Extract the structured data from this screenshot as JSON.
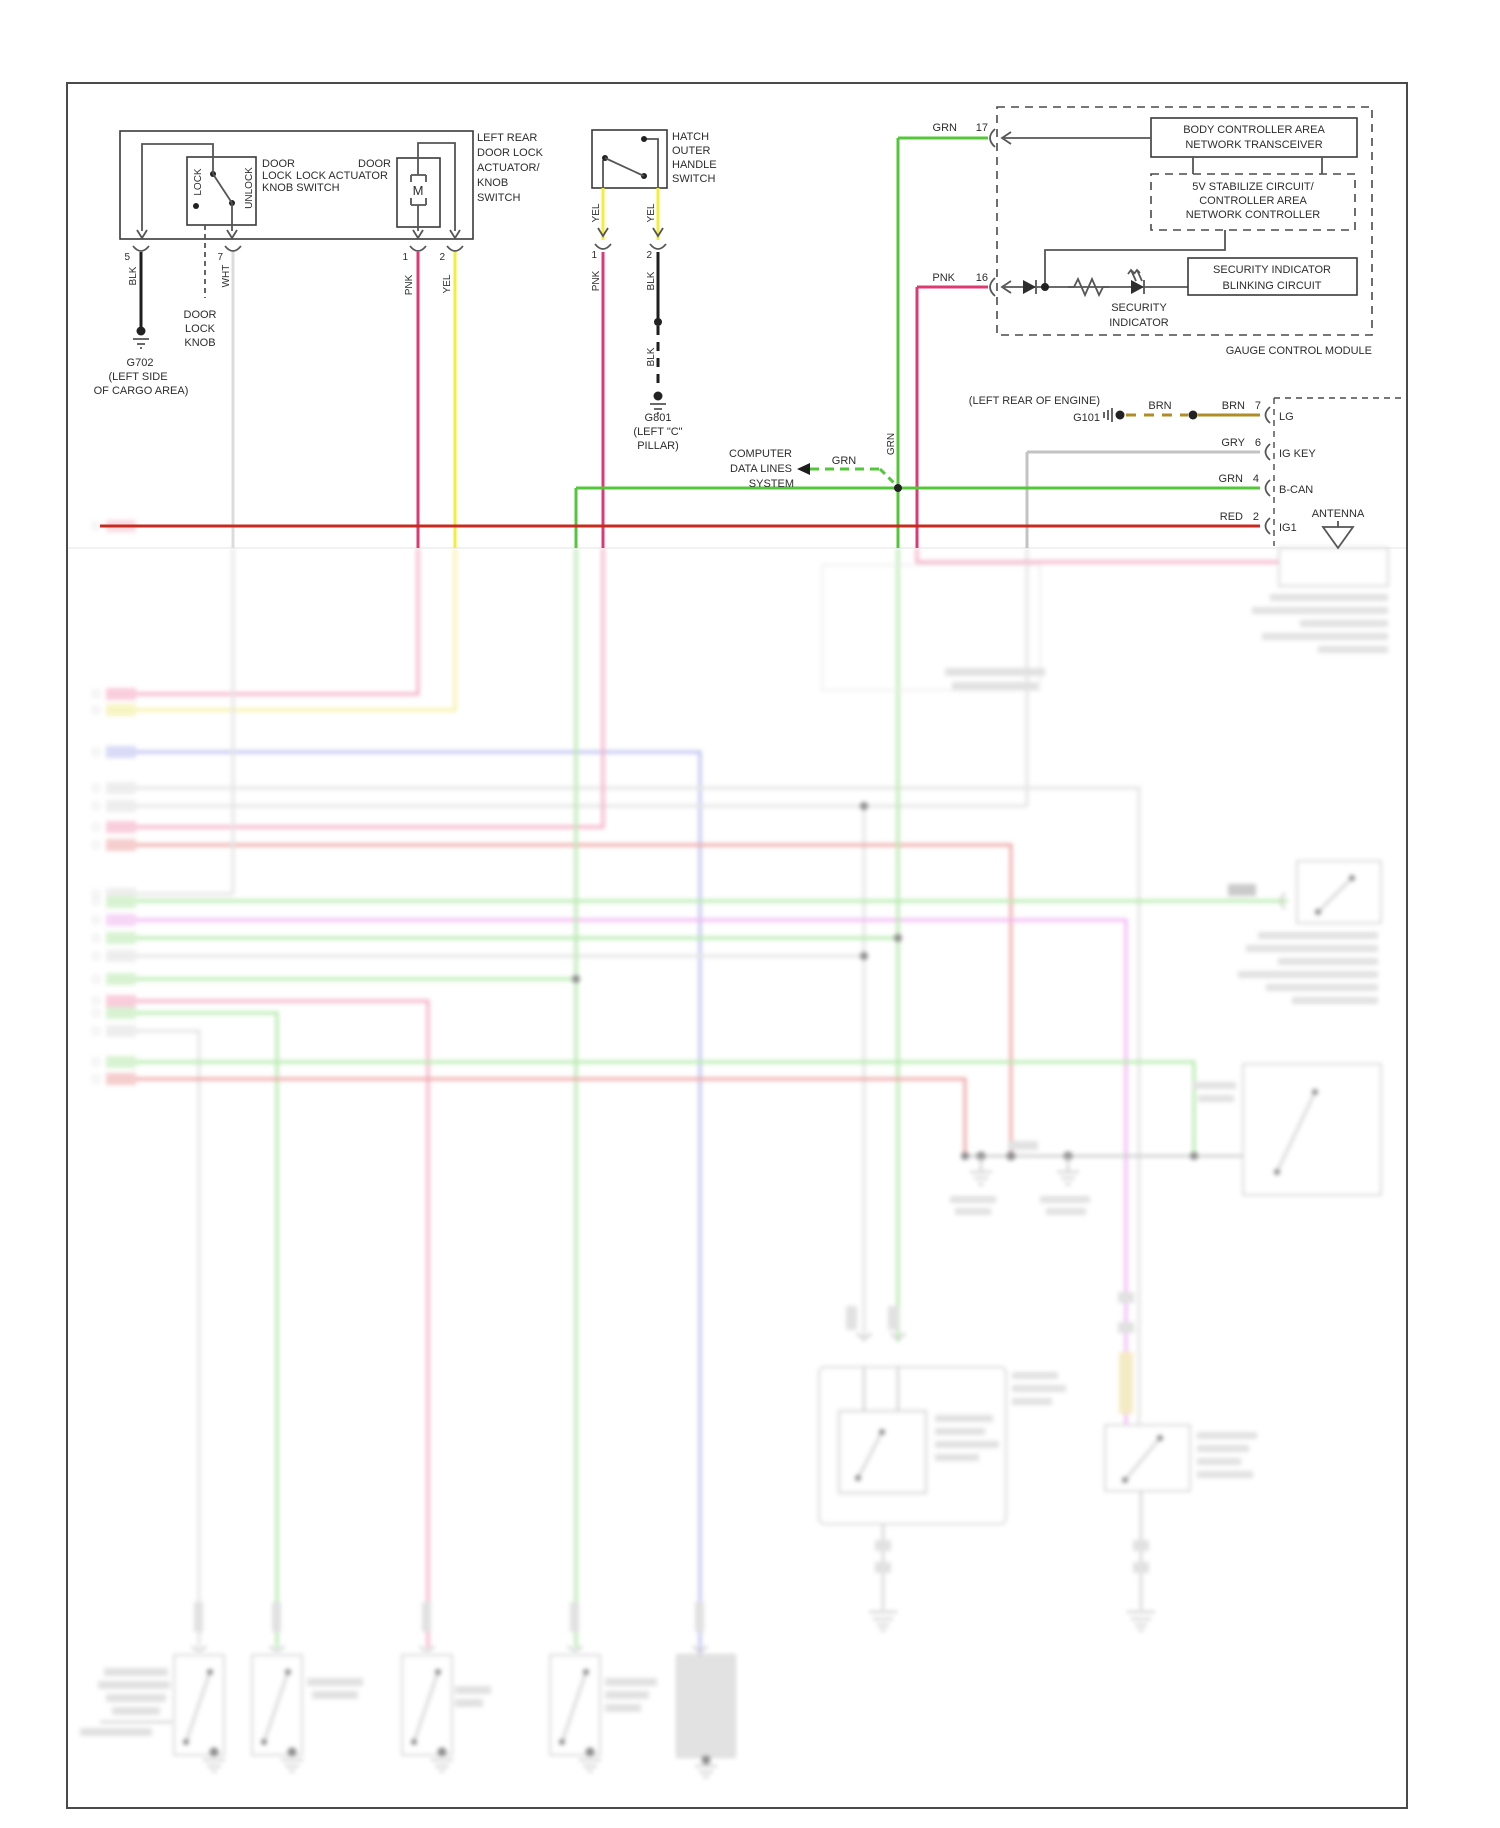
{
  "colors": {
    "pnk": "#dd3a74",
    "yel": "#f6ed3a",
    "grn": "#53c73a",
    "red": "#c72b20",
    "gry": "#c3c3c3",
    "wht": "#dcdcdc",
    "blk": "#1e1e1e",
    "brn": "#b08d26",
    "blur_blue": "#8a8fe0",
    "blur_magenta": "#e77de9"
  },
  "left_assembly": {
    "title_lines": [
      "LEFT REAR",
      "DOOR LOCK",
      "ACTUATOR/",
      "KNOB",
      "SWITCH"
    ],
    "switch_label_lines": [
      "DOOR",
      "LOCK",
      "KNOB SWITCH"
    ],
    "actuator_label_line1": "DOOR",
    "actuator_label_line2": "LOCK ACTUATOR",
    "lock": "LOCK",
    "unlock": "UNLOCK",
    "motor": "M",
    "pin5": "5",
    "pin7": "7",
    "pin1": "1",
    "pin2": "2",
    "wire_blk": "BLK",
    "wire_wht": "WHT",
    "wire_pnk": "PNK",
    "wire_yel": "YEL",
    "knob_lines": [
      "DOOR",
      "LOCK",
      "KNOB"
    ],
    "g702_lines": [
      "G702",
      "(LEFT SIDE",
      "OF CARGO AREA)"
    ]
  },
  "hatch": {
    "title_lines": [
      "HATCH",
      "OUTER",
      "HANDLE",
      "SWITCH"
    ],
    "pin1": "1",
    "pin2": "2",
    "yel_left": "YEL",
    "yel_right": "YEL",
    "pnk": "PNK",
    "blk": "BLK",
    "blk2": "BLK",
    "g801_lines": [
      "G801",
      "(LEFT \"C\"",
      "PILLAR)"
    ]
  },
  "module": {
    "grn": "GRN",
    "pin17": "17",
    "pnk": "PNK",
    "pin16": "16",
    "body_lines": [
      "BODY CONTROLLER AREA",
      "NETWORK TRANSCEIVER"
    ],
    "stab_lines": [
      "5V STABILIZE CIRCUIT/",
      "CONTROLLER AREA",
      "NETWORK CONTROLLER"
    ],
    "blink_lines": [
      "SECURITY  INDICATOR",
      "BLINKING  CIRCUIT"
    ],
    "sec_lines": [
      "SECURITY",
      "INDICATOR"
    ],
    "name": "GAUGE CONTROL MODULE"
  },
  "right": {
    "engine": "(LEFT REAR OF ENGINE)",
    "g101": "G101",
    "brn1": "BRN",
    "brn2": "BRN",
    "pin7": "7",
    "lg": "LG",
    "gry": "GRY",
    "pin6": "6",
    "ig_key": "IG KEY",
    "grn": "GRN",
    "pin4": "4",
    "b_can": "B-CAN",
    "red": "RED",
    "pin2": "2",
    "ig1": "IG1",
    "antenna": "ANTENNA"
  },
  "computer": {
    "lines": [
      "COMPUTER",
      "DATA LINES",
      "SYSTEM"
    ],
    "grn_label": "GRN",
    "grn_vert": "GRN"
  }
}
